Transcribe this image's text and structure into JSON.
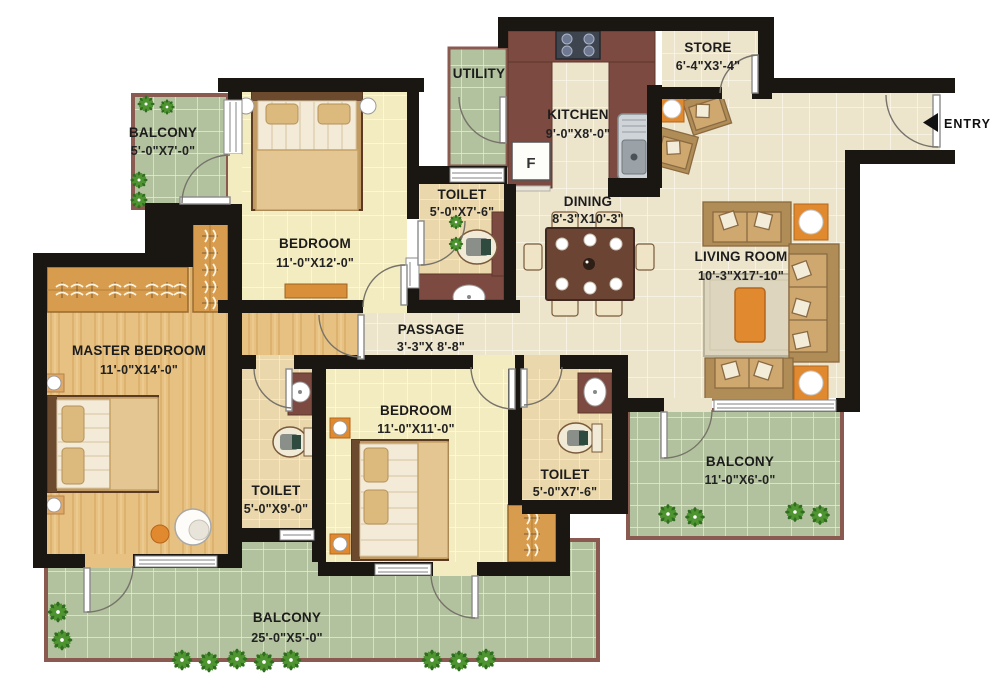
{
  "plan_title": "2 BHK + Store Apartment Floor Plan",
  "rooms": [
    {
      "name": "BALCONY",
      "dims": "5'-0\"X7'-0\""
    },
    {
      "name": "BEDROOM",
      "dims": "11'-0\"X12'-0\""
    },
    {
      "name": "UTILITY",
      "dims": ""
    },
    {
      "name": "KITCHEN",
      "dims": "9'-0\"X8'-0\""
    },
    {
      "name": "STORE",
      "dims": "6'-4\"X3'-4\""
    },
    {
      "name": "TOILET",
      "dims": "5'-0\"X7'-6\""
    },
    {
      "name": "DINING",
      "dims": "8'-3\"X10'-3\""
    },
    {
      "name": "LIVING ROOM",
      "dims": "10'-3\"X17'-10\""
    },
    {
      "name": "MASTER BEDROOM",
      "dims": "11'-0\"X14'-0\""
    },
    {
      "name": "PASSAGE",
      "dims": "3'-3\"X 8'-8\""
    },
    {
      "name": "BEDROOM",
      "dims": "11'-0\"X11'-0\""
    },
    {
      "name": "TOILET",
      "dims": "5'-0\"X9'-0\""
    },
    {
      "name": "TOILET",
      "dims": "5'-0\"X7'-6\""
    },
    {
      "name": "BALCONY",
      "dims": "11'-0\"X6'-0\""
    },
    {
      "name": "BALCONY",
      "dims": "25'-0\"X5'-0\""
    }
  ],
  "labels": {
    "entry": "ENTRY",
    "fridge": "F"
  },
  "colors": {
    "wall": "#1a1713",
    "cream_tile": "#ece4cb",
    "yellow_tile": "#f4ecc1",
    "green_tile": "#b3c29e",
    "tan_tile": "#ead7ab",
    "maroon": "#7c4a40",
    "wood_floor": "#e7c182",
    "balcony_border": "#8a5a50",
    "accent_orange": "#e0892e"
  }
}
